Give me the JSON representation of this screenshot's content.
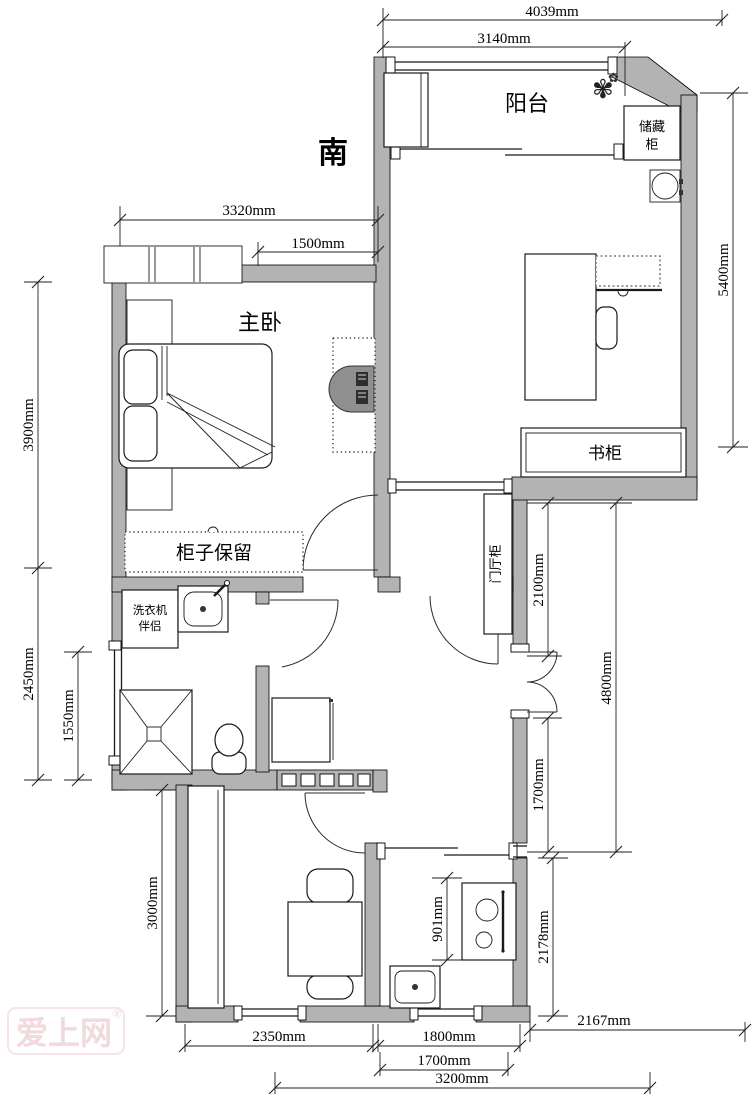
{
  "compass": {
    "south": "南"
  },
  "rooms": {
    "balcony": "阳台",
    "master_bedroom": "主卧"
  },
  "fixtures": {
    "storage_cabinet_line1": "储藏",
    "storage_cabinet_line2": "柜",
    "bookcase": "书柜",
    "keep_cabinet": "柜子保留",
    "washer_line1": "洗衣机",
    "washer_line2": "伴侣",
    "entry_cabinet": "门厅柜"
  },
  "dimensions": {
    "top_outer": "4039mm",
    "top_inner": "3140mm",
    "bedroom_top": "3320mm",
    "bedroom_top_right": "1500mm",
    "left_upper": "3900mm",
    "left_middle": "2450mm",
    "left_inner": "1550mm",
    "right_upper": "5400mm",
    "hall_upper": "2100mm",
    "hall_full": "4800mm",
    "hall_lower": "1700mm",
    "kitchen_right": "2178mm",
    "bottom_right": "2167mm",
    "room_bottom": "2350mm",
    "kitchen_bottom": "1800mm",
    "kitchen_bottom_inner": "1700mm",
    "bottom_span": "3200mm",
    "kitchen_inner": "901mm",
    "room_left": "3000mm"
  },
  "watermark": {
    "text": "爱上网",
    "reg": "®"
  },
  "icons": {
    "plant": "✾",
    "plant_small": "✿"
  }
}
